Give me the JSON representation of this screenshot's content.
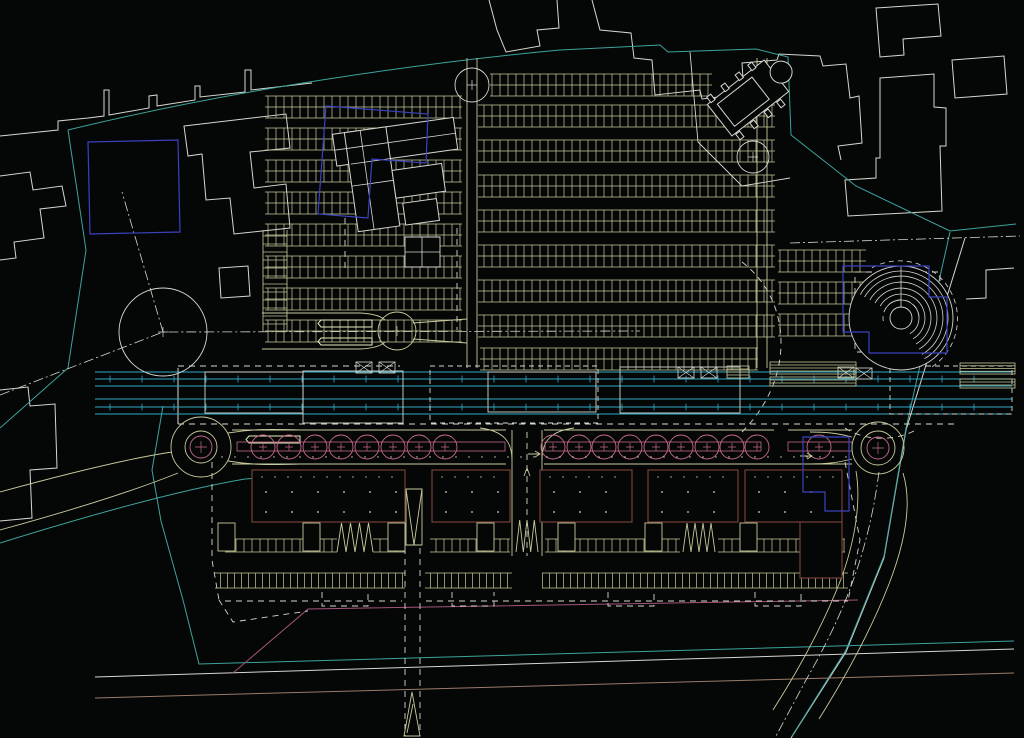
{
  "canvas": {
    "width": 1024,
    "height": 738
  },
  "palette": {
    "background": "#050606",
    "white": "#d6d7cf",
    "tan": "#c9cb9c",
    "brightTan": "#eaecc0",
    "teal": "#3da49d",
    "cyan": "#2fa9c8",
    "pink": "#c4688c",
    "deepPink": "#a5547a",
    "blue": "#3b42bf",
    "maroon": "#7e4439",
    "brown": "#9a7b69"
  },
  "layers_under": [
    {
      "name": "context-outlines",
      "color": "white",
      "width": 1,
      "paths": [
        "M0,136 L58,130 L58,121 L88,118 L104,116 L104,90 L109,90 L109,115 L149,108 L149,96 L157,95 L157,106 L195,100 L195,86 L200,86 L200,97 L245,92 L245,70 L251,70 L251,90 L312,83",
        "M489,0 L497,30 L506,52 L540,46 L537,30 L559,28 L557,0",
        "M592,0 L600,30 L631,33 L634,58 L652,60 L655,95 L700,90 L702,99 L744,94 L742,63 L777,60 L779,54 L820,56 L823,66 L846,64 L850,98 L859,96 L862,143 L838,146 L841,160",
        "M880,78 L934,74 L934,107 L946,108 L946,146 L940,146 L942,211 L848,216 L845,180 L876,178 L876,158 L880,158 Z",
        "M876,8 L938,4 L941,36 L903,39 L904,55 L880,57 Z",
        "M952,60 L1004,56 L1007,94 L955,98 Z",
        "M0,176 L30,172 L33,190 L62,186 L66,206 L40,209 L44,238 L14,242 L16,258 L0,260",
        "M184,126 L286,114 L290,148 L250,152 L254,188 L286,184 L290,228 L234,234 L230,198 L206,200 L202,154 L188,156 Z",
        "M219,268 L248,266 L250,296 L221,298 Z",
        "M0,390 L28,387 L30,406 L55,404 L57,468 L30,470 L32,518 L0,521",
        "M965,238 L906,430 L884,558 L846,652 L791,738",
        "M1014,268 L986,270 L986,298 L966,299",
        "M95,677 L1014,649",
        "M178,368 L178,424"
      ]
    },
    {
      "name": "site-boundary-teal",
      "color": "teal",
      "width": 1,
      "paths": [
        "M68,130 C240,88 430,62 560,50 L660,45 L668,52 L756,49 L788,57 L791,135 L856,186 L950,231 L1016,224",
        "M68,130 L86,250 L68,368 L0,428",
        "M0,543 C90,515 180,490 245,479 L312,474",
        "M163,406 L152,470 L161,521 L183,600 L199,664 L1014,641",
        "M950,232 L906,428 L884,556 L846,650 L792,736"
      ]
    },
    {
      "name": "utility-brown",
      "color": "brown",
      "width": 1,
      "paths": [
        "M95,698 L1014,673"
      ]
    },
    {
      "name": "utility-pink",
      "color": "deepPink",
      "width": 1,
      "paths": [
        "M233,673 L308,609 L858,600"
      ]
    },
    {
      "name": "centerlines-dashdot",
      "color": "white",
      "width": 0.8,
      "dash": "10 3 2 3",
      "paths": [
        "M0,395 L163,332 L640,331",
        "M163,332 L122,192",
        "M790,243 L1020,236",
        "M879,472 C870,540 851,602 806,680 L776,736"
      ]
    },
    {
      "name": "dashed-boundaries",
      "color": "white",
      "width": 0.9,
      "dash": "6 5",
      "paths": [
        "M178,424 L958,424",
        "M178,366 L400,366",
        "M212,462 L212,560 L219,600",
        "M219,600 L233,622 L308,611",
        "M225,601 L402,601",
        "M426,601 L848,601",
        "M405,548 L405,736",
        "M420,548 L420,736",
        "M527,432 L527,556",
        "M845,462 L860,540 L848,601",
        "M855,272 L940,272 L940,352 L855,352 Z",
        "M742,262 C792,300 796,378 742,432",
        "M457,228 L457,330",
        "M345,218 L345,268",
        "M322,592 L322,606 L368,606 L368,592",
        "M452,592 L452,606 L494,606 L494,592",
        "M608,592 L608,606 L654,606 L654,592",
        "M755,592 L755,606 L801,606 L801,592",
        "M845,428 C862,440 892,442 914,431"
      ]
    },
    {
      "name": "roads-tan",
      "color": "tan",
      "width": 0.9,
      "paths": [
        "M262,313 L360,313",
        "M262,349 L360,349",
        "M360,313 Q379,314 385,320",
        "M360,349 Q379,348 385,342",
        "M413,323 L467,319",
        "M413,339 L467,343",
        "M467,58 L467,368",
        "M477,58 L477,368",
        "M757,58 L757,368",
        "M767,58 L767,368",
        "M232,430 L506,430",
        "M544,430 L774,430",
        "M788,430 L852,430",
        "M232,464 L506,464",
        "M544,464 L852,464",
        "M228,433 C252,429 270,429 300,430",
        "M228,461 C252,465 270,465 300,464",
        "M512,430 L512,556",
        "M542,430 L542,556",
        "M480,428 C504,431 512,442 512,460",
        "M574,428 C550,431 542,442 542,460",
        "M903,473 C912,502 906,540 889,584 C873,625 851,668 819,719",
        "M856,471 C861,500 856,538 841,579 C824,623 801,666 773,710",
        "M852,437 C836,433 826,432 810,432",
        "M852,459 C836,463 826,464 810,464",
        "M0,492 C80,470 132,458 172,452",
        "M0,530 C80,508 136,490 178,473",
        "M406,489 L422,489 L422,545 L406,545 Z",
        "M406,489 L414,545",
        "M422,489 L414,545",
        "M404,736 L412,692 L420,736 Z",
        "M407,733 L413,704",
        "M524,476 L527,468 L530,476"
      ]
    }
  ],
  "parking": {
    "band_h": 22,
    "bands": [
      [
        265,
        96,
        197
      ],
      [
        265,
        128,
        197
      ],
      [
        265,
        160,
        197
      ],
      [
        265,
        192,
        197
      ],
      [
        265,
        224,
        197
      ],
      [
        265,
        256,
        197
      ],
      [
        265,
        288,
        197
      ],
      [
        265,
        320,
        197
      ],
      [
        490,
        74,
        222
      ],
      [
        478,
        105,
        297
      ],
      [
        478,
        140,
        297
      ],
      [
        478,
        175,
        297
      ],
      [
        478,
        210,
        297
      ],
      [
        478,
        245,
        297
      ],
      [
        478,
        280,
        297
      ],
      [
        478,
        315,
        297
      ],
      [
        480,
        348,
        278
      ],
      [
        778,
        250,
        88
      ],
      [
        778,
        282,
        88
      ],
      [
        778,
        314,
        88
      ]
    ],
    "vband": [
      263,
      230,
      24,
      102
    ],
    "islands": [
      [
        318,
        320,
        54,
        7
      ],
      [
        318,
        338,
        54,
        7
      ],
      [
        246,
        436,
        54,
        7
      ]
    ]
  },
  "transit": {
    "x1": 95,
    "x2": 1012,
    "line_ys": [
      372,
      379,
      386,
      399,
      407,
      414
    ],
    "tick_ys": [
      379,
      407
    ],
    "tick_step": 32,
    "tick_len": 7,
    "platforms": [
      [
        205,
        372,
        98,
        41,
        0
      ],
      [
        303,
        371,
        100,
        52,
        0
      ],
      [
        430,
        366,
        168,
        57,
        1
      ],
      [
        488,
        372,
        108,
        40,
        0
      ],
      [
        620,
        367,
        120,
        46,
        0
      ],
      [
        890,
        366,
        122,
        48,
        1
      ]
    ],
    "crossing_boxes": [
      [
        356,
        362
      ],
      [
        379,
        362
      ],
      [
        678,
        367
      ],
      [
        701,
        367
      ],
      [
        838,
        367
      ],
      [
        856,
        368
      ]
    ],
    "box_w": 16,
    "box_h": 11,
    "striped_boxes": [
      [
        727,
        366,
        22,
        12,
        3
      ],
      [
        770,
        362,
        86,
        12,
        3
      ],
      [
        770,
        377,
        86,
        9,
        2
      ],
      [
        960,
        363,
        55,
        11,
        3
      ],
      [
        960,
        379,
        55,
        9,
        2
      ]
    ]
  },
  "circles": [
    {
      "cx": 397,
      "cy": 331,
      "r": 19,
      "color": "tan"
    },
    {
      "cx": 472,
      "cy": 85,
      "r": 17,
      "color": "white"
    },
    {
      "cx": 753,
      "cy": 157,
      "r": 16,
      "color": "white"
    },
    {
      "cx": 163,
      "cy": 332,
      "r": 44,
      "color": "white"
    }
  ],
  "spiral": {
    "cx": 901,
    "cy": 318,
    "outer": 52,
    "inner": 11,
    "arcs": [
      18,
      24,
      30,
      36,
      42,
      47
    ],
    "arc_start": 150,
    "arc_end": -60,
    "dashed": [
      [
        58,
        120,
        -60
      ],
      [
        18,
        190,
        -10
      ]
    ],
    "stem": "M901,307 L901,266"
  },
  "avenue": {
    "tree_y": 447,
    "tree_radius": 12,
    "tree_groups": [
      [
        263,
        289,
        315,
        341,
        367,
        393,
        419,
        445
      ],
      [
        553,
        579,
        604,
        630,
        656,
        681,
        707,
        732,
        757
      ],
      [
        819
      ]
    ],
    "hedge_bands": [
      [
        237,
        442,
        268,
        9
      ],
      [
        545,
        442,
        216,
        9
      ],
      [
        788,
        442,
        64,
        9
      ]
    ],
    "roundabouts": [
      {
        "cx": 201,
        "cy": 447,
        "rings": [
          [
            30,
            "tan"
          ],
          [
            16,
            "tan"
          ],
          [
            11,
            "pink"
          ]
        ]
      },
      {
        "cx": 878,
        "cy": 448,
        "rings": [
          [
            26,
            "tan"
          ],
          [
            17,
            "tan"
          ],
          [
            11,
            "pink"
          ]
        ]
      }
    ],
    "arrows": [
      "M528,454 h12 m-5,-3 l5,3 l-5,3",
      "M800,456 h12 m-5,-3 l5,3 l-5,3"
    ]
  },
  "lower_site": {
    "buildings": [
      [
        252,
        470,
        153,
        52
      ],
      [
        432,
        470,
        78,
        52
      ],
      [
        540,
        470,
        92,
        52
      ],
      [
        648,
        470,
        90,
        52
      ],
      [
        745,
        470,
        97,
        52
      ],
      [
        800,
        522,
        42,
        56
      ]
    ],
    "pavilions": [
      [
        218,
        523
      ],
      [
        303,
        523
      ],
      [
        388,
        523
      ],
      [
        477,
        523
      ],
      [
        558,
        523
      ],
      [
        645,
        523
      ],
      [
        740,
        523
      ]
    ],
    "pavilion_w": 17,
    "pavilion_h": 28,
    "zigzags": [
      [
        337,
        523,
        36,
        29,
        4
      ],
      [
        516,
        520,
        22,
        32,
        3
      ],
      [
        683,
        523,
        32,
        29,
        4
      ]
    ],
    "stall_rows_outer": [
      [
        225,
        539,
        112
      ],
      [
        373,
        539,
        32
      ],
      [
        430,
        539,
        80
      ],
      [
        545,
        539,
        135
      ],
      [
        718,
        539,
        127
      ]
    ],
    "stall_rows_dense": [
      [
        215,
        573,
        190
      ],
      [
        425,
        573,
        87
      ],
      [
        542,
        573,
        306
      ]
    ],
    "stall_h": 13,
    "dense_h": 15,
    "dot_row_y": 457,
    "dot_row_x": [
      222,
      848
    ],
    "dot_step": 13
  },
  "layers_over": [
    {
      "name": "farm-building",
      "color": "white",
      "width": 1,
      "fill": true,
      "transform": "rotate(-8 395 170)",
      "paths": [
        "M338,126 h122 v32 h-122 Z",
        "M350,126 h42 v100 h-42 Z",
        "M392,170 h50 v28 h-50 Z",
        "M398,204 h34 v22 h-34 Z"
      ]
    },
    {
      "name": "farm-building-walls",
      "color": "white",
      "width": 0.8,
      "transform": "rotate(-8 395 170)",
      "paths": [
        "M338,142 L460,142",
        "M366,126 L366,226",
        "M350,180 L392,180",
        "M352,158 L392,158"
      ]
    },
    {
      "name": "barn-building",
      "color": "white",
      "width": 0.9,
      "fill": true,
      "paths": [
        "M405,237 h35 v30 h-35 Z"
      ]
    },
    {
      "name": "barn-building-walls",
      "color": "white",
      "width": 0.8,
      "paths": [
        "M405,252 L440,252",
        "M422,237 L422,267"
      ]
    },
    {
      "name": "church-building",
      "color": "white",
      "width": 1,
      "fill": true,
      "transform": "rotate(-38 748 98)",
      "paths": [
        "M712,78 h72 v40 h-72 Z",
        "M720,84 h44 v28 h-44 Z",
        "M779,98 a11,11 0 1,0 22,0 a11,11 0 1,0 -22,0",
        "M716,72 h5 v7 h-5 Z",
        "M734,72 h5 v7 h-5 Z",
        "M752,72 h5 v7 h-5 Z",
        "M768,72 h5 v7 h-5 Z",
        "M716,119 h5 v7 h-5 Z",
        "M734,119 h5 v7 h-5 Z",
        "M752,119 h5 v7 h-5 Z",
        "M768,119 h5 v7 h-5 Z"
      ]
    },
    {
      "name": "church-enclosure",
      "color": "white",
      "width": 0.9,
      "paths": [
        "M690,52 L698,142 L742,186 L790,178"
      ]
    },
    {
      "name": "blue-overlays",
      "color": "blue",
      "width": 1.2,
      "paths": [
        "M88,142 L178,140 L180,232 L90,234 Z",
        "M326,106 L428,114 L426,163 L372,159 L368,218 L318,214 Z",
        "M843,266 L929,266 L929,297 L947,297 L947,353 L869,353 L869,332 L843,332 Z",
        "M803,437 L849,437 L849,511 L825,511 L825,492 L803,492 Z"
      ]
    }
  ]
}
